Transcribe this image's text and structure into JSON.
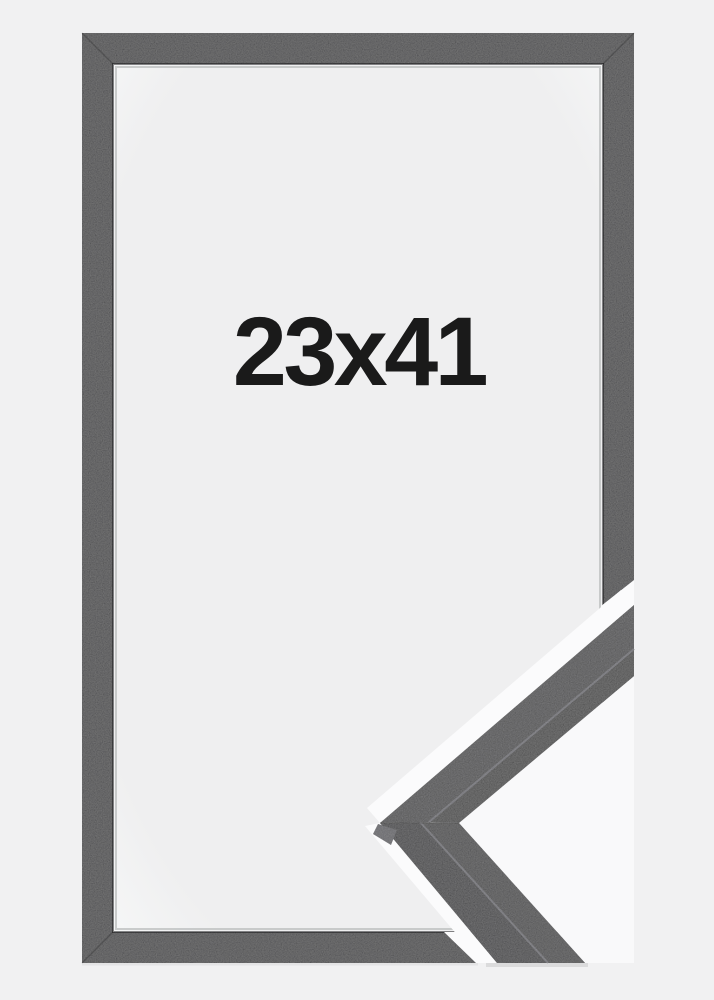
{
  "product_photo": {
    "size_label": "23x41"
  },
  "colors": {
    "background": "#f1f1f2",
    "mat_center": "#efeff0",
    "mat_edge": "#f7f8f8",
    "frame": "#333335",
    "frame_inner_edge_shadow": "rgba(18,18,20,0.5)",
    "mat_hairline": "rgba(190,193,193,0.8)",
    "miter_seam": "rgba(0,0,0,0.2)",
    "cut_gap": "#fbfbfc",
    "pocket": "#f9f9fa",
    "profile_face_upper": "#3b3b3d",
    "profile_side_upper": "#303032",
    "profile_face_lower": "#363638",
    "profile_side_lower": "#2c2c2e",
    "profile_edge_highlight": "#64646a",
    "profile_corner_facet": "#55555a",
    "profile_seam": "rgba(0,0,0,0.3)",
    "clip_shadow": "#c9c9cb",
    "bar_shadow": "rgba(0,0,0,0.05)",
    "label": "#1a1a1a"
  }
}
